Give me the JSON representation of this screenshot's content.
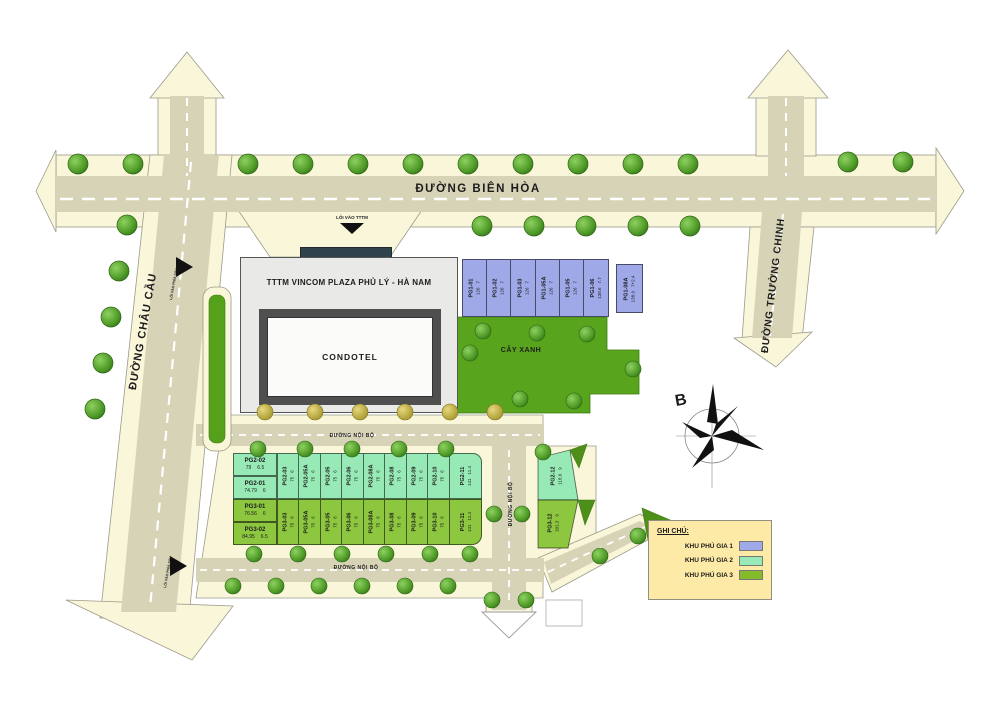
{
  "roads": {
    "bien_hoa": "ĐƯỜNG BIÊN HÒA",
    "chau_cau": "ĐƯỜNG CHÂU CẦU",
    "truong_chinh": "ĐƯỜNG TRƯỜNG CHINH",
    "noi_bo_mid": "ĐƯỜNG NỘI BỘ",
    "noi_bo_bottom": "ĐƯỜNG NỘI BỘ",
    "noi_bo_vertical": "ĐƯỜNG NỘI BỘ",
    "entrance_tttm": "LỐI VÀO TTTM",
    "entrance_rear_top": "LỐI VÀO PHÍA SAU",
    "entrance_rear_bottom": "LỐI VÀO PHÍA SAU"
  },
  "building": {
    "tttm_label": "TTTM VINCOM PLAZA PHỦ LÝ -  HÀ NAM",
    "condotel_label": "CONDOTEL"
  },
  "green_area_label": "CÂY XANH",
  "compass_label": "B",
  "legend": {
    "title": "GHI CHÚ:",
    "items": [
      {
        "label": "KHU PHÚ GIA 1",
        "color": "#9fa9e8"
      },
      {
        "label": "KHU PHÚ GIA 2",
        "color": "#97e9b5"
      },
      {
        "label": "KHU PHÚ GIA 3",
        "color": "#84bb2a"
      }
    ]
  },
  "plots": {
    "pg1": [
      {
        "name": "PG1-01",
        "area": "126",
        "width": "7"
      },
      {
        "name": "PG1-02",
        "area": "126",
        "width": "7"
      },
      {
        "name": "PG1-03",
        "area": "126",
        "width": "7"
      },
      {
        "name": "PG1-05A",
        "area": "126",
        "width": "7"
      },
      {
        "name": "PG1-05",
        "area": "126",
        "width": "7"
      },
      {
        "name": "PG1-06",
        "area": "138.6",
        "width": "7.7"
      },
      {
        "name": "PG1-08A",
        "area": "138.9",
        "width": "7+2.4"
      }
    ],
    "pg2_left": [
      {
        "name": "PG2-02",
        "area": "79",
        "width": "6.5"
      },
      {
        "name": "PG2-01",
        "area": "74.79",
        "width": "6"
      }
    ],
    "pg2": [
      {
        "name": "PG2-03",
        "area": "75",
        "width": "6"
      },
      {
        "name": "PG2-05A",
        "area": "75",
        "width": "6"
      },
      {
        "name": "PG2-05",
        "area": "75",
        "width": "6"
      },
      {
        "name": "PG2-06",
        "area": "75",
        "width": "6"
      },
      {
        "name": "PG2-08A",
        "area": "75",
        "width": "6"
      },
      {
        "name": "PG2-08",
        "area": "75",
        "width": "6"
      },
      {
        "name": "PG2-09",
        "area": "75",
        "width": "6"
      },
      {
        "name": "PG2-10",
        "area": "75",
        "width": "6"
      },
      {
        "name": "PG2-11",
        "area": "141",
        "width": "11.4"
      },
      {
        "name": "PG2-12",
        "area": "118.9",
        "width": "9"
      }
    ],
    "pg3_left": [
      {
        "name": "PG3-01",
        "area": "76.56",
        "width": "6"
      },
      {
        "name": "PG3-02",
        "area": "84.95",
        "width": "6.5"
      }
    ],
    "pg3": [
      {
        "name": "PG3-03",
        "area": "75",
        "width": "6"
      },
      {
        "name": "PG3-05A",
        "area": "75",
        "width": "6"
      },
      {
        "name": "PG3-05",
        "area": "75",
        "width": "6"
      },
      {
        "name": "PG3-06",
        "area": "75",
        "width": "6"
      },
      {
        "name": "PG3-08A",
        "area": "75",
        "width": "6"
      },
      {
        "name": "PG3-08",
        "area": "75",
        "width": "6"
      },
      {
        "name": "PG3-09",
        "area": "75",
        "width": "6"
      },
      {
        "name": "PG3-10",
        "area": "75",
        "width": "6"
      },
      {
        "name": "PG3-11",
        "area": "141",
        "width": "11.4"
      },
      {
        "name": "PG3-12",
        "area": "101.3",
        "width": "9"
      }
    ]
  },
  "colors": {
    "road_surface": "#d7d3b6",
    "sidewalk": "#faf6da",
    "green_area": "#58a51d",
    "khu1": "#9fa9e8",
    "khu2": "#97e9b5",
    "khu3": "#8dc63f",
    "legend_bg": "#fdeaa6"
  }
}
